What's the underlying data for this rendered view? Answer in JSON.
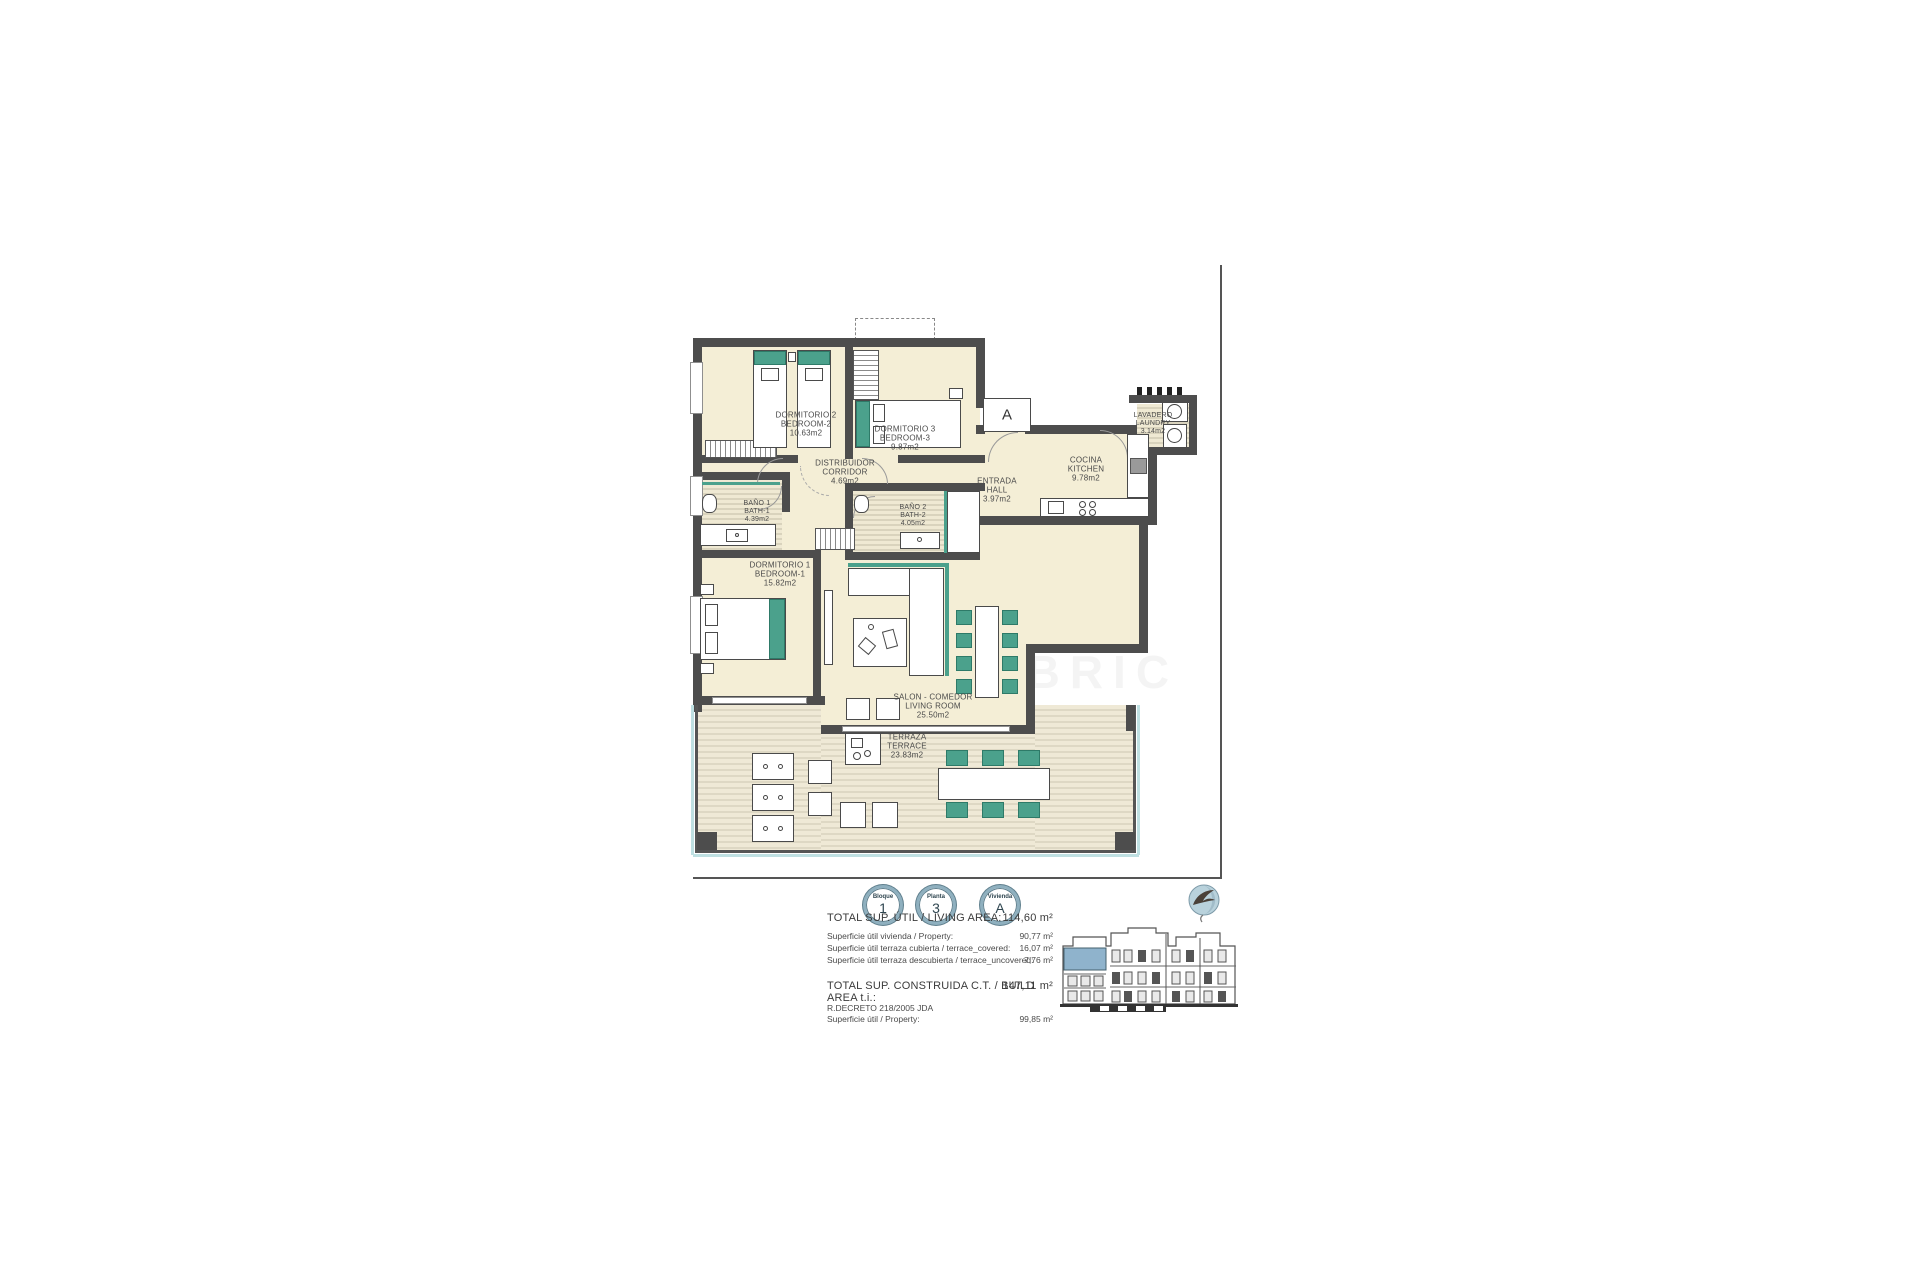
{
  "plan": {
    "rooms": [
      {
        "name_es": "DORMITORIO 2",
        "name_en": "BEDROOM-2",
        "area": "10.63m2"
      },
      {
        "name_es": "DORMITORIO 3",
        "name_en": "BEDROOM-3",
        "area": "9.87m2"
      },
      {
        "name_es": "DISTRIBUIDOR",
        "name_en": "CORRIDOR",
        "area": "4.69m2"
      },
      {
        "name_es": "ENTRADA",
        "name_en": "HALL",
        "area": "3.97m2"
      },
      {
        "name_es": "COCINA",
        "name_en": "KITCHEN",
        "area": "9.78m2"
      },
      {
        "name_es": "LAVADERO",
        "name_en": "LAUNDRY",
        "area": "3.14m2"
      },
      {
        "name_es": "BAÑO 1",
        "name_en": "BATH-1",
        "area": "4.39m2"
      },
      {
        "name_es": "BAÑO 2",
        "name_en": "BATH-2",
        "area": "4.05m2"
      },
      {
        "name_es": "DORMITORIO 1",
        "name_en": "BEDROOM-1",
        "area": "15.82m2"
      },
      {
        "name_es": "SALON - COMEDOR",
        "name_en": "LIVING ROOM",
        "area": "25.50m2"
      },
      {
        "name_es": "TERRAZA",
        "name_en": "TERRACE",
        "area": "23.83m2"
      }
    ],
    "section_marker": "A",
    "watermark": "GOLD BRIC"
  },
  "badges": [
    {
      "label": "Bloque",
      "value": "1"
    },
    {
      "label": "Planta",
      "value": "3"
    },
    {
      "label": "Vivienda",
      "value": "A"
    }
  ],
  "summary": {
    "total_living_label": "TOTAL SUP. ÚTIL / LIVING AREA:",
    "total_living_value": "114,60 m²",
    "rows": [
      {
        "label": "Superficie útil vivienda / Property:",
        "value": "90,77 m²"
      },
      {
        "label": "Superficie útil terraza cubierta / terrace_covered:",
        "value": "16,07 m²"
      },
      {
        "label": "Superficie útil terraza descubierta / terrace_uncovered:",
        "value": "7,76 m²"
      }
    ],
    "total_built_label": "TOTAL SUP. CONSTRUIDA C.T. / BUILD AREA t.i.:",
    "total_built_value": "147,11 m²",
    "decree_label": "R.DECRETO 218/2005 JDA",
    "decree_row": {
      "label": "Superficie útil / Property:",
      "value": "99,85 m²"
    }
  },
  "colors": {
    "accent_teal": "#4BA18C",
    "wall_gray": "#4D4D4D",
    "floor_cream": "#F4EED6",
    "unit_highlight_blue": "#8FB3CC",
    "badge_ring": "#8FB0BF"
  }
}
